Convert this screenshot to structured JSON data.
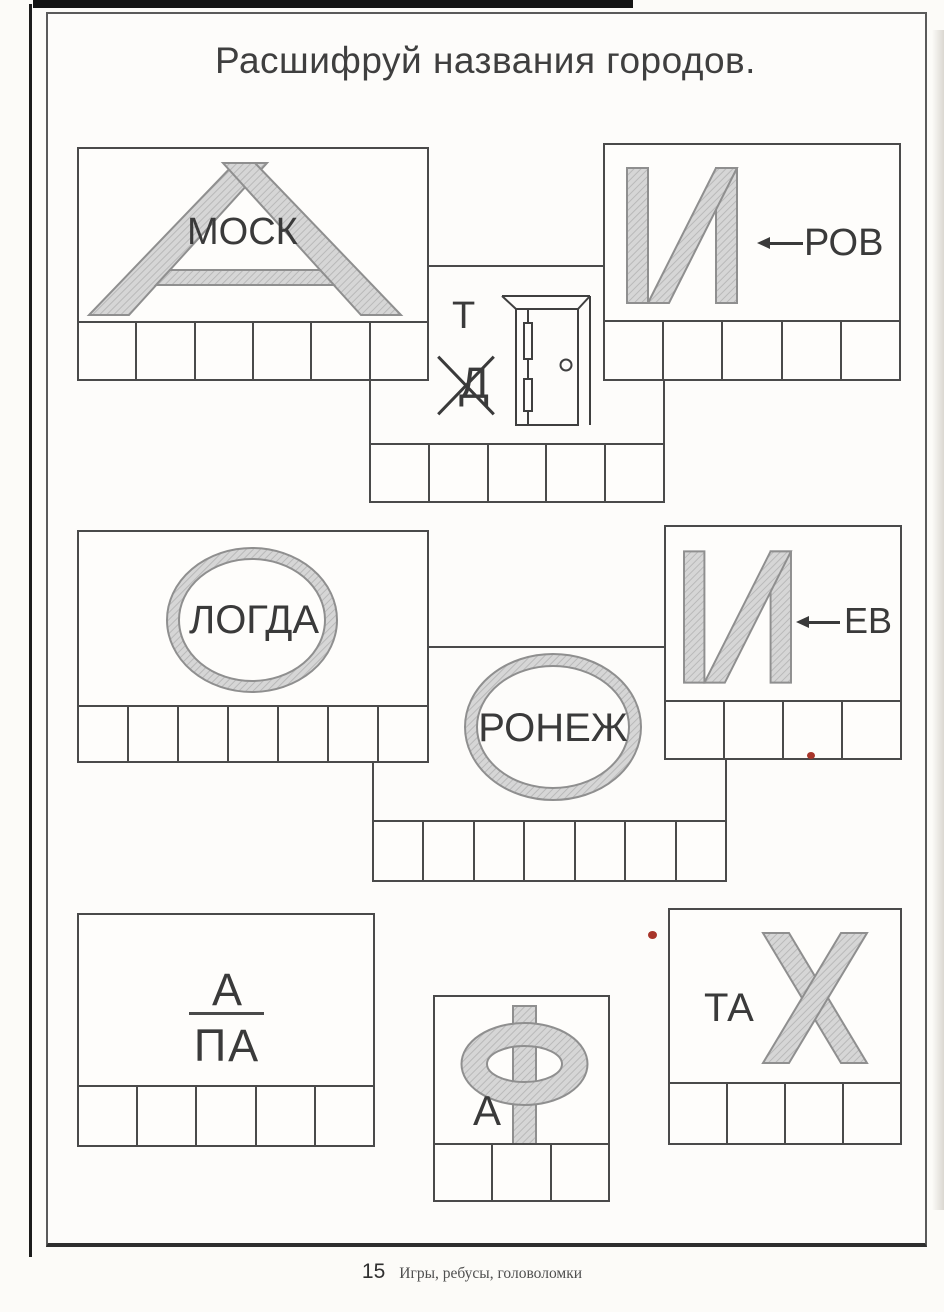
{
  "title": "Расшифруй названия городов.",
  "puzzles": {
    "moskva": {
      "big_letter": "А",
      "inner_text": "МОСК",
      "cells": 6
    },
    "kirov": {
      "big_letter": "И",
      "arrow": "left-arrow",
      "text_after_arrow": "РОВ",
      "cells": 5
    },
    "tver": {
      "letter_top": "Т",
      "letter_crossed_out": "Д",
      "picture": "door",
      "cells": 5
    },
    "vologda": {
      "ring_letter": "О",
      "inner_text": "ЛОГДА",
      "cells": 7
    },
    "kiev": {
      "big_letter": "И",
      "arrow": "left-arrow",
      "text_after_arrow": "ЕВ",
      "cells": 4
    },
    "voronezh": {
      "ring_letter": "О",
      "inner_text": "РОНЕЖ",
      "cells": 7
    },
    "anapa": {
      "numerator": "А",
      "denominator": "ПА",
      "cells": 5
    },
    "ufa": {
      "big_letter": "Ф",
      "small_letter": "А",
      "cells": 3
    },
    "ukhta": {
      "big_letter": "Х",
      "small_text": "ТА",
      "cells": 4
    }
  },
  "footer": {
    "page_number": "15",
    "book_title": "Игры, ребусы, головоломки"
  },
  "colors": {
    "line": "#4a4a4a",
    "letter_fill": "#d6d6d6",
    "letter_hatch": "#b9b9b9",
    "letter_outline": "#8f8f8f",
    "red_dot": "#a8352a"
  }
}
